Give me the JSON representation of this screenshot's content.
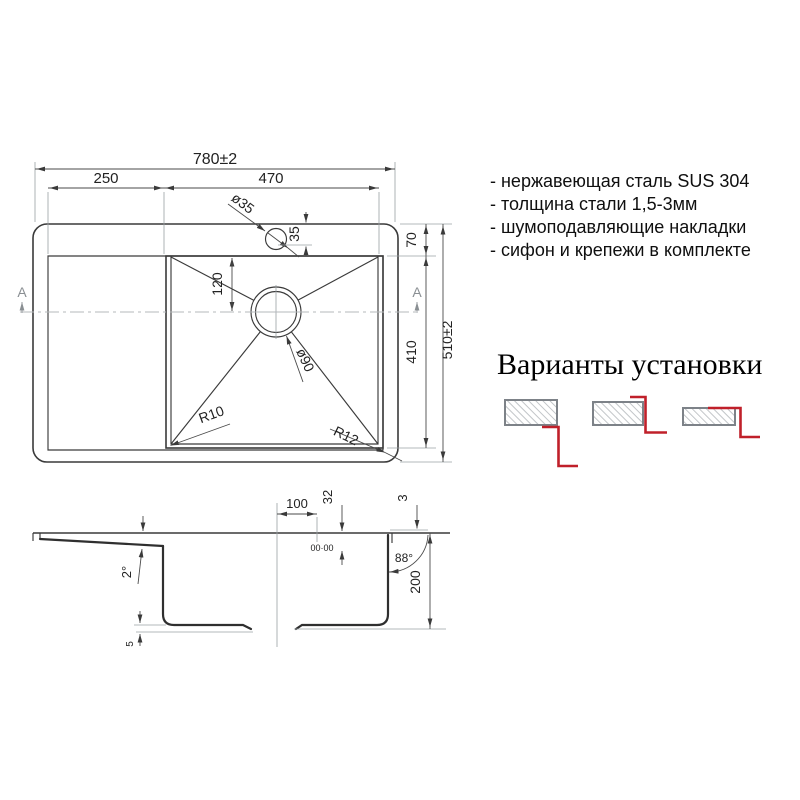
{
  "drawing": {
    "top_view": {
      "overall_width": "780±2",
      "wing_width": "250",
      "bowl_width": "470",
      "faucet_diameter": "ø35",
      "faucet_offset": "35",
      "rim_to_bowl": "70",
      "drain_from_top": "120",
      "bowl_length": "410",
      "overall_depth": "510±2",
      "corner_radius_left": "R10",
      "corner_radius_right": "R12",
      "drain_diameter": "ø90",
      "section_label": "A"
    },
    "section_view": {
      "drain_offset": "100",
      "drain_depth": "32",
      "rim_height": "3",
      "wall_angle": "88°",
      "bowl_depth": "200",
      "wing_slope": "2°",
      "pad_height": "5",
      "drain_mark": "00·00"
    }
  },
  "features": [
    "- нержавеющая сталь SUS 304",
    "- толщина стали 1,5-3мм",
    "- шумоподавляющие накладки",
    "- сифон и крепежи в комплекте"
  ],
  "install": {
    "title": "Варианты установки"
  },
  "colors": {
    "accent_red": "#c0202a",
    "hatch": "#b3b7bb",
    "hatch_border": "#7d8288"
  }
}
